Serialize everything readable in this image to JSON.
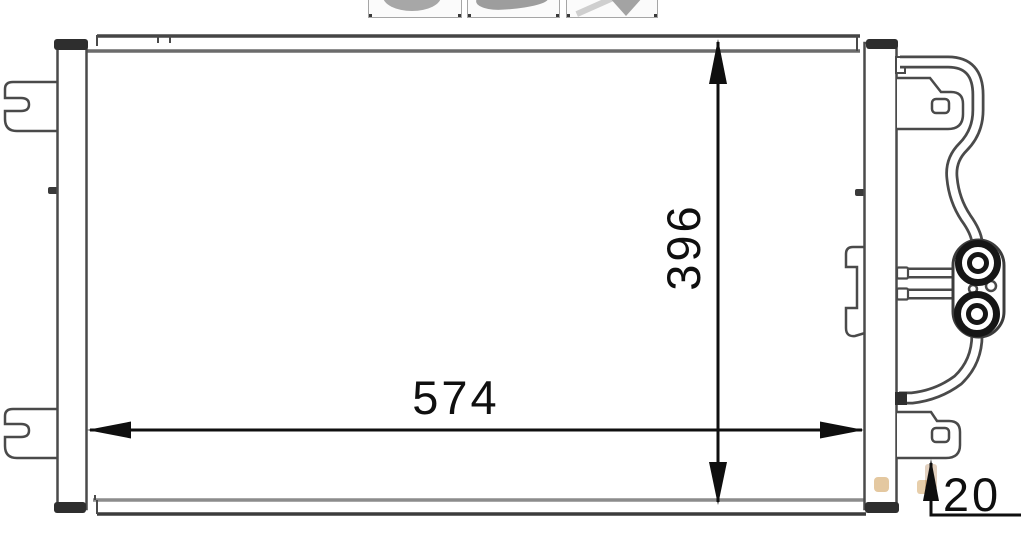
{
  "page": {
    "background": "#ffffff"
  },
  "gallery": {
    "items": [
      {
        "name": "thumbnail-1"
      },
      {
        "name": "thumbnail-2"
      },
      {
        "name": "thumbnail-3"
      }
    ]
  },
  "drawing": {
    "stroke_color": "#4a4a4a",
    "cap_color": "#2e2e2e",
    "dimension_color": "#0f0f0f",
    "watermark_color": "#c99242",
    "dimensions": {
      "width_mm": "574",
      "height_mm": "396",
      "depth_mm": "20"
    }
  }
}
